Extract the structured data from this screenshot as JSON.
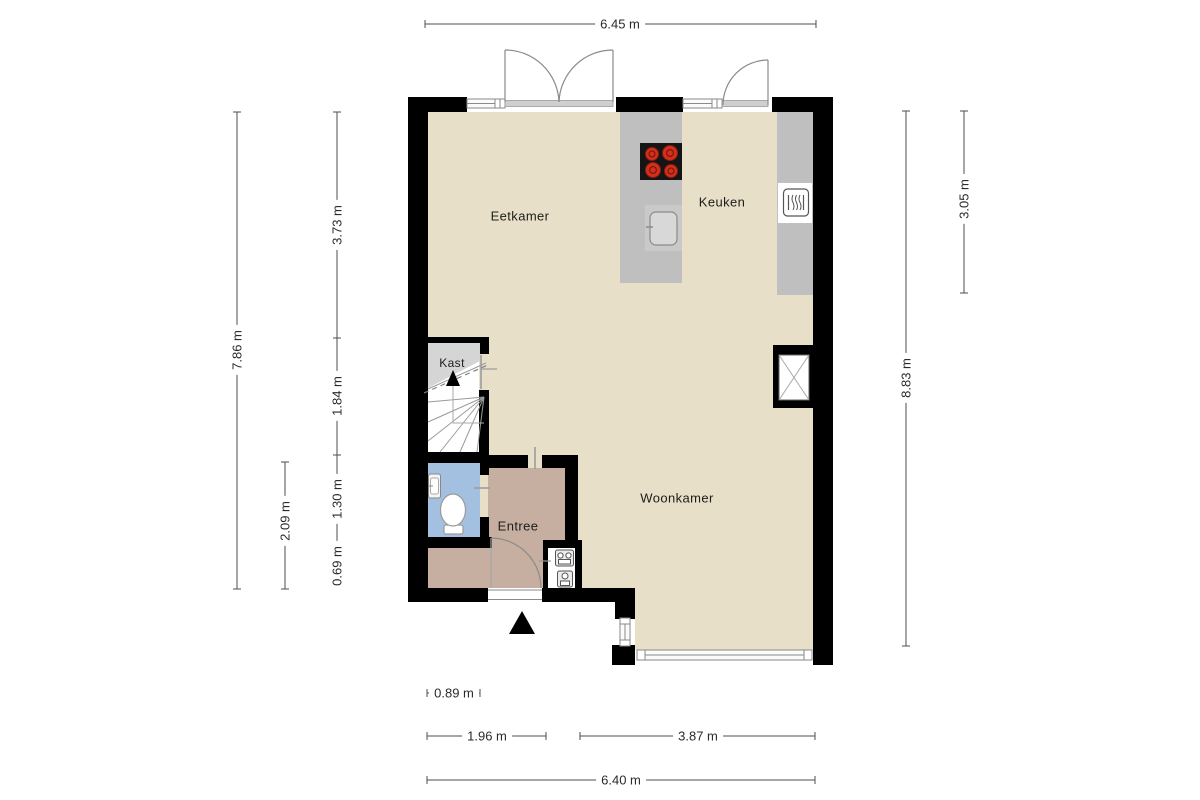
{
  "rooms": {
    "eetkamer": "Eetkamer",
    "keuken": "Keuken",
    "woonkamer": "Woonkamer",
    "kast": "Kast",
    "entree": "Entree"
  },
  "dimensions": {
    "top_total": "6.45 m",
    "left_total": "7.86 m",
    "left_entree_block": "2.09 m",
    "left_eetkamer": "3.73 m",
    "left_stairs": "1.84 m",
    "left_toilet": "1.30 m",
    "left_hall": "0.69 m",
    "right_total": "8.83 m",
    "right_keuken": "3.05 m",
    "bottom_porch": "0.89 m",
    "bottom_entree": "1.96 m",
    "bottom_woonkamer": "3.87 m",
    "bottom_total": "6.40 m"
  },
  "icons": {
    "stove": "stove-icon",
    "sink": "sink-icon",
    "dishwasher": "dishwasher-icon",
    "toilet": "toilet-icon",
    "washbasin": "washbasin-icon",
    "meters": "meter-icons",
    "stairs_arrow": "stairs-up-arrow-icon",
    "entrance_arrow": "entrance-arrow-icon",
    "shaft": "shaft-x-icon"
  },
  "colors": {
    "wall": "#000000",
    "floor": "#e7dfc7",
    "entree_floor": "#c6afa0",
    "toilet_floor": "#a4c0e0",
    "kast_fill": "#d5d5d5",
    "counter": "#bfbfbf",
    "burner_red": "#d2301c",
    "dim": "#4d4d4d"
  }
}
